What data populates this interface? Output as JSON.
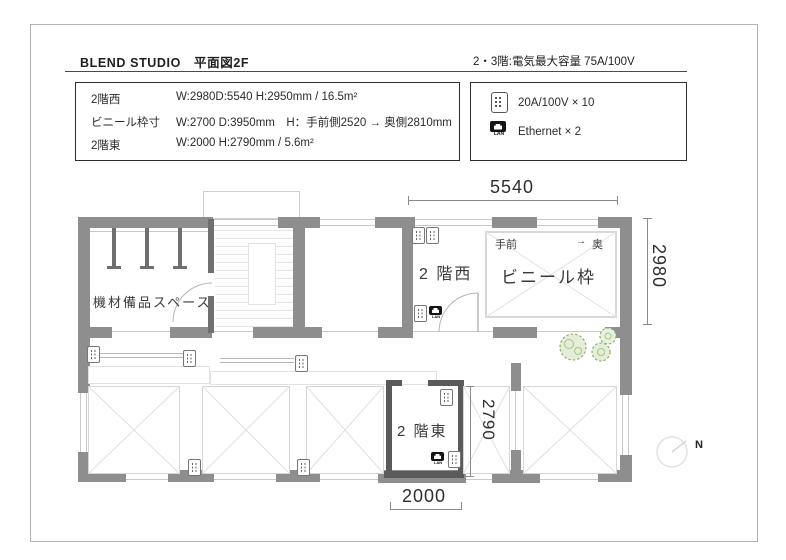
{
  "header": {
    "title": "BLEND STUDIO　平面図2F",
    "capacity_note": "2・3階:電気最大容量  75A/100V"
  },
  "spec_table": {
    "rows": [
      {
        "label": "2階西",
        "value": "W:2980D:5540 H:2950mm / 16.5m²"
      },
      {
        "label": "ビニール枠寸",
        "value": "W:2700 D:3950mm　H：手前側2520 → 奥側2810mm"
      },
      {
        "label": "2階東",
        "value": "W:2000 H:2790mm  / 5.6m²"
      }
    ]
  },
  "legend": {
    "items": [
      {
        "icon": "outlet-icon",
        "label": "20A/100V × 10"
      },
      {
        "icon": "lan-icon",
        "label": "Ethernet × 2"
      }
    ],
    "lan_text": "LAN"
  },
  "plan": {
    "labels": {
      "storage": "機材備品スペース",
      "west_room": "2 階西",
      "east_room": "2 階東",
      "vinyl_frame": "ビニール枠",
      "front": "手前",
      "arrow": "→",
      "back": "奥"
    },
    "dimensions": {
      "west_width": "5540",
      "west_depth": "2980",
      "east_depth": "2790",
      "east_width": "2000"
    },
    "compass_label": "N"
  },
  "colors": {
    "wall": "#8e8e8e",
    "dark_wall": "#5a5a5a",
    "plant_green": "#8fb06c",
    "text": "#333333"
  }
}
